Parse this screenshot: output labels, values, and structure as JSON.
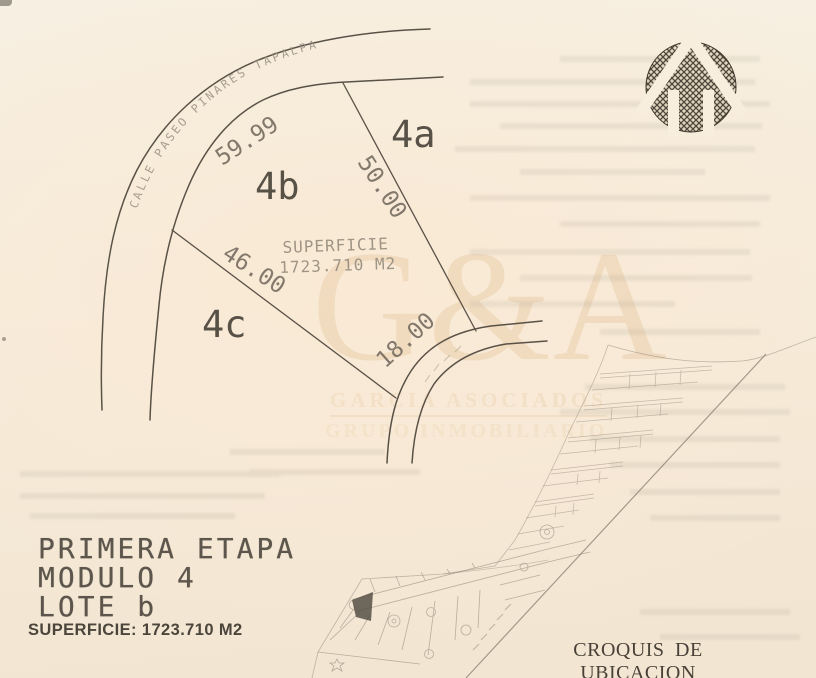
{
  "colors": {
    "paper": "#f6ecdb",
    "ink": "#4c453b",
    "faint_ink": "#6f6456",
    "watermark": "#ecd0ae"
  },
  "plot": {
    "street": "CALLE PASEO PINARES TAPALPA",
    "lot_a": "4a",
    "lot_b": "4b",
    "lot_c": "4c",
    "m_front": "59.99",
    "m_right": "50.00",
    "m_left": "46.00",
    "m_rear": "18.00",
    "area_line1": "SUPERFICIE",
    "area_line2": "1723.710 M2"
  },
  "watermark": {
    "monogram": "G&A",
    "firm_line1": "GARCIA ASOCIADOS",
    "firm_line2": "GRUPO INMOBILIARIO"
  },
  "title_block": {
    "etapa": "PRIMERA ETAPA",
    "modulo": "MODULO 4",
    "lote": "LOTE b",
    "superficie": "SUPERFICIE: 1723.710 M2"
  },
  "croquis": {
    "caption": "CROQUIS DE UBICACION"
  }
}
